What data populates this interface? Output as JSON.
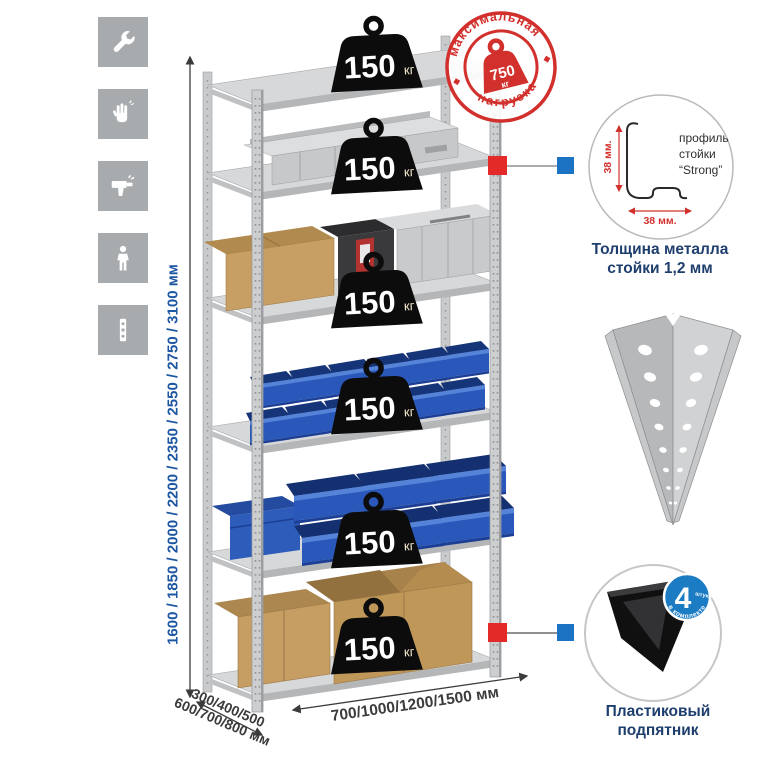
{
  "sidebar": {
    "icons": [
      {
        "name": "wrench-icon"
      },
      {
        "name": "gloves-icon"
      },
      {
        "name": "drill-icon"
      },
      {
        "name": "person-icon"
      },
      {
        "name": "profile-strip-icon"
      }
    ]
  },
  "rack": {
    "shelf_loads": [
      {
        "value": "150",
        "unit": "кг"
      },
      {
        "value": "150",
        "unit": "кг"
      },
      {
        "value": "150",
        "unit": "кг"
      },
      {
        "value": "150",
        "unit": "кг"
      },
      {
        "value": "150",
        "unit": "кг"
      },
      {
        "value": "150",
        "unit": "кг"
      }
    ]
  },
  "stamp": {
    "arc_top": "максимальная",
    "arc_bottom": "нагрузка",
    "value": "750",
    "unit": "кг"
  },
  "dimensions": {
    "height": "1600 / 1850 / 2000 / 2200 / 2350 / 2550 / 2750 / 3100 мм",
    "depth_line1": "300/400/500",
    "depth_line2": "600/700/800 мм",
    "width": "700/1000/1200/1500 мм"
  },
  "profile_detail": {
    "dim_vertical": "38 мм.",
    "dim_horizontal": "38 мм.",
    "label_line1": "профиль",
    "label_line2": "стойки",
    "label_line3": "“Strong”",
    "caption_line1": "Толщина металла",
    "caption_line2": "стойки 1,2 мм"
  },
  "foot_detail": {
    "badge_value": "4",
    "badge_small": "штуки",
    "badge_arc": "в комплекте",
    "caption_line1": "Пластиковый",
    "caption_line2": "подпятник"
  },
  "colors": {
    "accent_red": "#e42a28",
    "accent_blue": "#1c73c3",
    "stamp_red": "#d2302c",
    "bin_blue": "#2a58ba",
    "dim_blue": "#1d56a2",
    "caption_navy": "#1e3e6d"
  }
}
